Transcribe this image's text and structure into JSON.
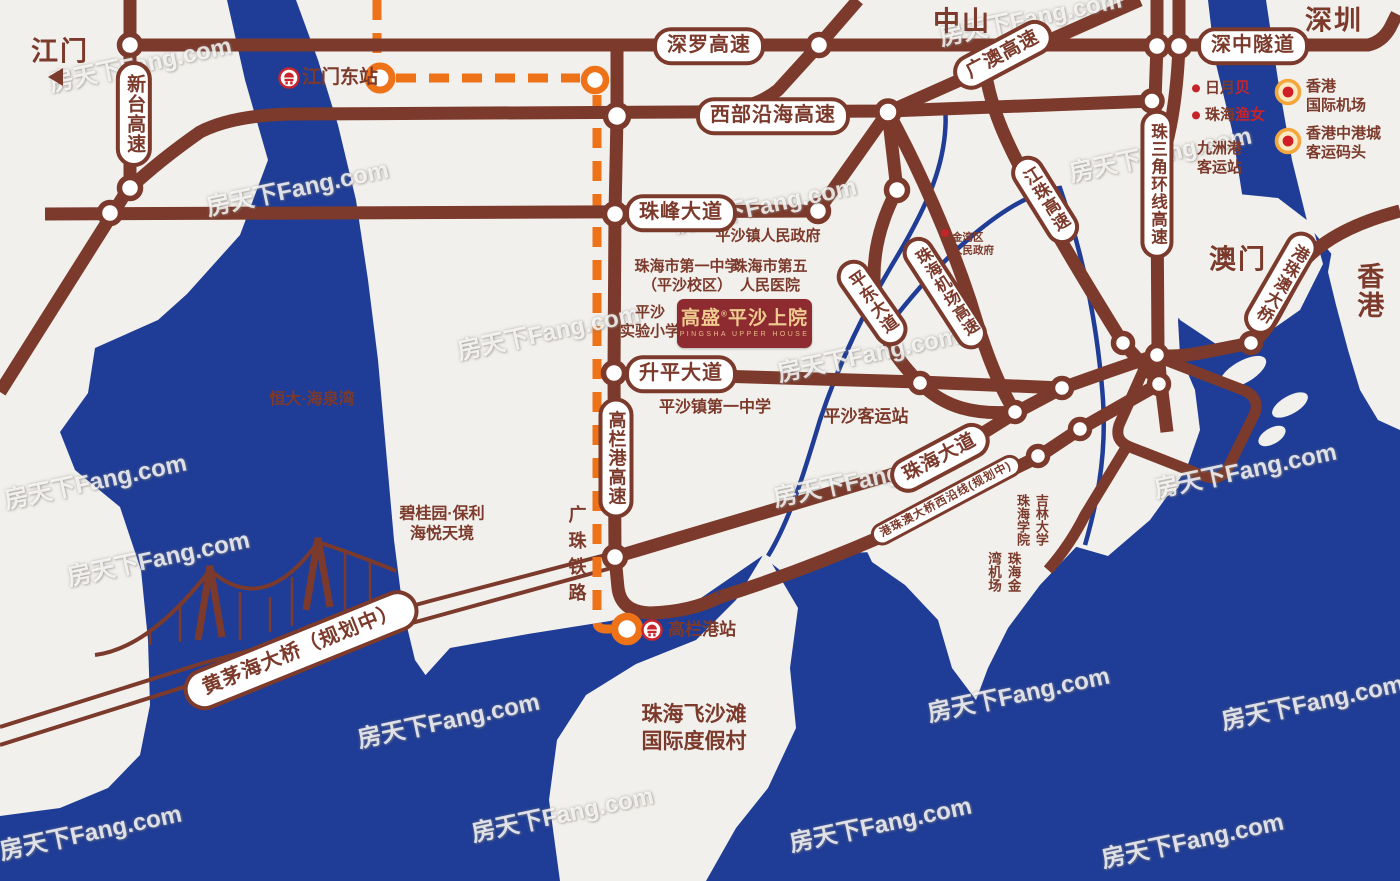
{
  "watermark": "房天下Fang.com",
  "colors": {
    "land": "#F2F0EC",
    "water": "#1F3D96",
    "road": "#7B3A2B",
    "railway_orange": "#ED7218",
    "station_red": "#C9252C",
    "accent_red": "#C5242B",
    "logo_bg": "#8E2B31",
    "logo_gold": "#EFCB90"
  },
  "cities": {
    "jiangmen": "江门",
    "zhongshan": "中山",
    "shenzhen": "深圳",
    "aomen": "澳门",
    "xianggang": "香港"
  },
  "roads": {
    "xintai": "新台高速",
    "shenluo": "深罗高速",
    "shenzhong": "深中隧道",
    "guangao": "广澳高速",
    "xibu_yanhai": "西部沿海高速",
    "zhufeng": "珠峰大道",
    "zhusanjiao_huanxian": "珠三角环线高速",
    "jiangzhu": "江珠高速",
    "jichang_gaosu": "珠海机场高速",
    "pingdong": "平东大道",
    "shengping": "升平大道",
    "gaolangang_gaosu": "高栏港高速",
    "zhuhai_dadao": "珠海大道",
    "hzmb_west": "港珠澳大桥西沿线(规划中)",
    "hzmb": "港珠澳大桥",
    "huangmaohai": "黄茅海大桥（规划中）",
    "guangzhu_tielu": "广珠铁路"
  },
  "stations": {
    "jiangmen_dong": "江门东站",
    "gaolangang_zhan": "高栏港站"
  },
  "pois": {
    "pingsha_gov": "平沙镇人民政府",
    "no1_school": {
      "line1": "珠海市第一中学",
      "line2": "（平沙校区）"
    },
    "fifth_hospital": {
      "line1": "珠海市第五",
      "line2": "人民医院"
    },
    "shiyan_primary": {
      "line1": "平沙",
      "line2": "实验小学"
    },
    "pingsha_no1_school": "平沙镇第一中学",
    "pingsha_keyun": "平沙客运站",
    "hengda": "恒大·海泉湾",
    "biguiyuan": {
      "line1": "碧桂园·保利",
      "line2": "海悦天境"
    },
    "jiuzhougang": {
      "line1": "九洲港",
      "line2": "客运站"
    },
    "jinwan_gov": {
      "line1": "金湾区",
      "line2": "人民政府"
    },
    "riyuebei": {
      "part1": "日月",
      "part2": "贝"
    },
    "yunv": {
      "part1": "珠海",
      "part2": "渔女"
    },
    "hk_airport": {
      "line1": "香港",
      "line2": "国际机场"
    },
    "hk_ferry": {
      "line1": "香港中港城",
      "line2": "客运码头"
    },
    "jilin": {
      "col1": "吉林大学",
      "col2": "珠海学院"
    },
    "jinwan_airport": {
      "col1": "珠海金",
      "col2": "湾机场"
    },
    "feishatan": {
      "line1": "珠海飞沙滩",
      "line2": "国际度假村"
    }
  },
  "logo": {
    "brand": "高盛",
    "reg": "®",
    "name": "平沙上院",
    "subtitle": "PINGSHA UPPER HOUSE"
  }
}
